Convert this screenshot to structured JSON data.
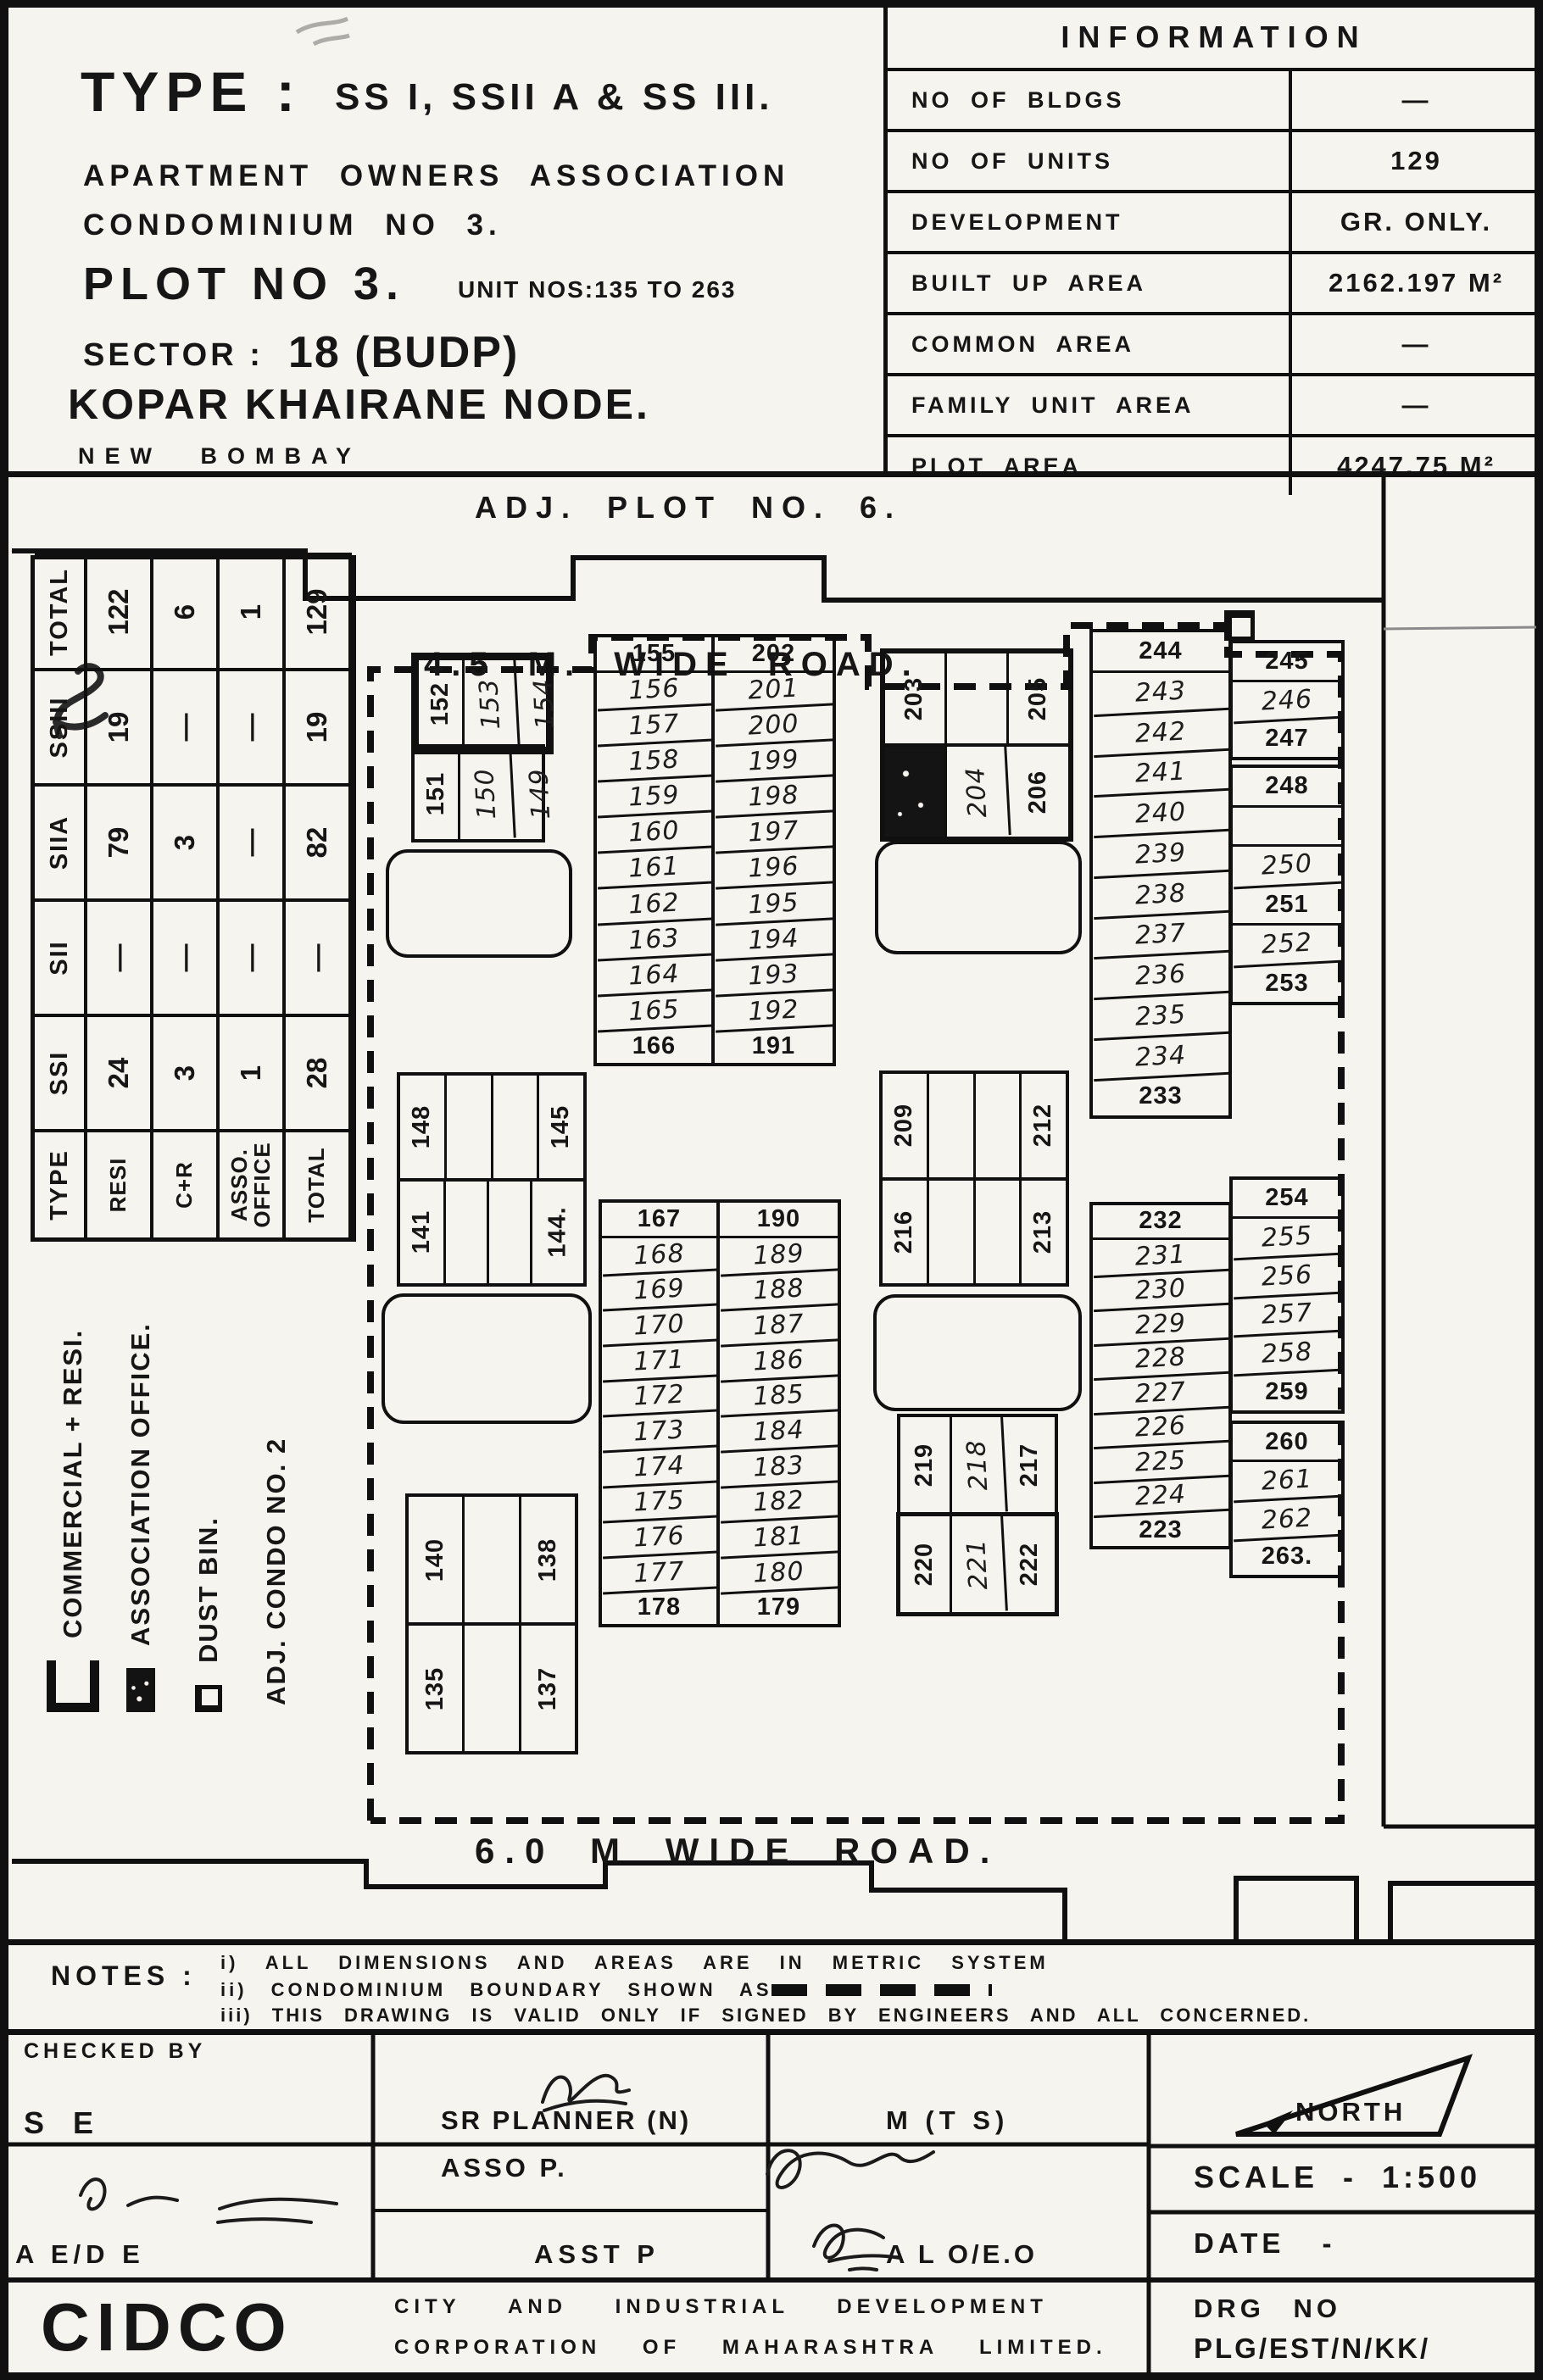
{
  "title_block": {
    "type_label": "TYPE :",
    "type_value": "SS I, SSII A & SS III.",
    "line_association": "APARTMENT OWNERS ASSOCIATION",
    "line_condominium": "CONDOMINIUM NO 3.",
    "plot_label": "PLOT NO 3.",
    "unit_nos": "UNIT NOS:135 TO 263",
    "sector_label": "SECTOR :",
    "sector_value": "18 (BUDP)",
    "node_line": "KOPAR KHAIRANE NODE.",
    "city_line": "NEW BOMBAY"
  },
  "info_table": {
    "title": "INFORMATION",
    "rows": [
      {
        "label": "NO OF BLDGS",
        "value": "—"
      },
      {
        "label": "NO OF UNITS",
        "value": "129"
      },
      {
        "label": "DEVELOPMENT",
        "value": "GR. ONLY."
      },
      {
        "label": "BUILT UP AREA",
        "value": "2162.197 M²"
      },
      {
        "label": "COMMON AREA",
        "value": "—"
      },
      {
        "label": "FAMILY UNIT AREA",
        "value": "—"
      },
      {
        "label": "PLOT AREA",
        "value": "4247.75 M²"
      }
    ]
  },
  "summary_table": {
    "col_headers": [
      "TYPE",
      "SSI",
      "SII",
      "SIIA",
      "SSIII",
      "TOTAL"
    ],
    "rows": [
      {
        "label": "RESI",
        "values": [
          "24",
          "—",
          "79",
          "19",
          "122"
        ]
      },
      {
        "label": "C+R",
        "values": [
          "3",
          "—",
          "3",
          "—",
          "6"
        ]
      },
      {
        "label": "ASSO. OFFICE",
        "values": [
          "1",
          "—",
          "—",
          "—",
          "1"
        ]
      },
      {
        "label": "TOTAL",
        "values": [
          "28",
          "—",
          "82",
          "19",
          "129"
        ]
      }
    ]
  },
  "legend": {
    "items": [
      {
        "symbol": "commercial",
        "label": "COMMERCIAL + RESI."
      },
      {
        "symbol": "association",
        "label": "ASSOCIATION OFFICE."
      },
      {
        "symbol": "dustbin",
        "label": "DUST BIN."
      },
      {
        "symbol": "none",
        "label": "ADJ. CONDO NO. 2"
      }
    ]
  },
  "plan": {
    "adj_plot_top": "ADJ. PLOT NO. 6.",
    "road_top": "4.5 M. WIDE ROAD.",
    "road_bottom": "6.0 M WIDE ROAD.",
    "adj_condo_right": "ADJ. CONDO NO. 4.",
    "block_a": {
      "vertical": true,
      "rows": [
        [
          "152",
          {
            "v": "153",
            "hw": true
          },
          {
            "v": "154",
            "hw": true
          }
        ]
      ]
    },
    "block_b": {
      "vertical": true,
      "rows": [
        [
          "151",
          {
            "v": "150",
            "hw": true
          },
          {
            "v": "149",
            "hw": true
          }
        ]
      ]
    },
    "block_c": {
      "vertical": true,
      "rows": [
        [
          "148",
          "",
          "",
          "145"
        ],
        [
          "141",
          "",
          "",
          "144."
        ]
      ]
    },
    "block_d": {
      "vertical": true,
      "rows": [
        [
          "140",
          "",
          "138"
        ],
        [
          "135",
          "",
          "137"
        ]
      ]
    },
    "block_e": {
      "vertical": true,
      "rows": [
        [
          "203",
          "",
          "205"
        ],
        [
          {
            "fill": true
          },
          {
            "v": "204",
            "hw": true
          },
          "206"
        ]
      ]
    },
    "block_f": {
      "vertical": true,
      "rows": [
        [
          "209",
          "",
          "",
          "212"
        ],
        [
          "216",
          "",
          "",
          "213"
        ]
      ]
    },
    "block_g": {
      "vertical": true,
      "bold_row": 1,
      "rows": [
        [
          "219",
          {
            "v": "218",
            "hw": true
          },
          "217"
        ],
        [
          "220",
          {
            "v": "221",
            "hw": true
          },
          "222"
        ]
      ]
    },
    "strip_155_left": [
      "155",
      {
        "v": "156",
        "hw": true
      },
      {
        "v": "157",
        "hw": true
      },
      {
        "v": "158",
        "hw": true
      },
      {
        "v": "159",
        "hw": true
      },
      {
        "v": "160",
        "hw": true
      },
      {
        "v": "161",
        "hw": true
      },
      {
        "v": "162",
        "hw": true
      },
      {
        "v": "163",
        "hw": true
      },
      {
        "v": "164",
        "hw": true
      },
      {
        "v": "165",
        "hw": true
      },
      "166"
    ],
    "strip_155_right": [
      "202",
      {
        "v": "201",
        "hw": true
      },
      {
        "v": "200",
        "hw": true
      },
      {
        "v": "199",
        "hw": true
      },
      {
        "v": "198",
        "hw": true
      },
      {
        "v": "197",
        "hw": true
      },
      {
        "v": "196",
        "hw": true
      },
      {
        "v": "195",
        "hw": true
      },
      {
        "v": "194",
        "hw": true
      },
      {
        "v": "193",
        "hw": true
      },
      {
        "v": "192",
        "hw": true
      },
      "191"
    ],
    "strip_167_left": [
      "167",
      {
        "v": "168",
        "hw": true
      },
      {
        "v": "169",
        "hw": true
      },
      {
        "v": "170",
        "hw": true
      },
      {
        "v": "171",
        "hw": true
      },
      {
        "v": "172",
        "hw": true
      },
      {
        "v": "173",
        "hw": true
      },
      {
        "v": "174",
        "hw": true
      },
      {
        "v": "175",
        "hw": true
      },
      {
        "v": "176",
        "hw": true
      },
      {
        "v": "177",
        "hw": true
      },
      "178"
    ],
    "strip_167_right": [
      "190",
      {
        "v": "189",
        "hw": true
      },
      {
        "v": "188",
        "hw": true
      },
      {
        "v": "187",
        "hw": true
      },
      {
        "v": "186",
        "hw": true
      },
      {
        "v": "185",
        "hw": true
      },
      {
        "v": "184",
        "hw": true
      },
      {
        "v": "183",
        "hw": true
      },
      {
        "v": "182",
        "hw": true
      },
      {
        "v": "181",
        "hw": true
      },
      {
        "v": "180",
        "hw": true
      },
      "179"
    ],
    "strip_244": [
      "244",
      {
        "v": "243",
        "hw": true
      },
      {
        "v": "242",
        "hw": true
      },
      {
        "v": "241",
        "hw": true
      },
      {
        "v": "240",
        "hw": true
      },
      {
        "v": "239",
        "hw": true
      },
      {
        "v": "238",
        "hw": true
      },
      {
        "v": "237",
        "hw": true
      },
      {
        "v": "236",
        "hw": true
      },
      {
        "v": "235",
        "hw": true
      },
      {
        "v": "234",
        "hw": true
      },
      "233"
    ],
    "strip_232": [
      "232",
      {
        "v": "231",
        "hw": true
      },
      {
        "v": "230",
        "hw": true
      },
      {
        "v": "229",
        "hw": true
      },
      {
        "v": "228",
        "hw": true
      },
      {
        "v": "227",
        "hw": true
      },
      {
        "v": "226",
        "hw": true
      },
      {
        "v": "225",
        "hw": true
      },
      {
        "v": "224",
        "hw": true
      },
      "223"
    ],
    "strip_245_g1": [
      "245",
      {
        "v": "246",
        "hw": true
      },
      "247"
    ],
    "strip_245_g2": [
      "248",
      "",
      {
        "v": "250",
        "hw": true
      },
      "251",
      {
        "v": "252",
        "hw": true
      },
      "253"
    ],
    "strip_245_g3": [
      "254",
      {
        "v": "255",
        "hw": true
      },
      {
        "v": "256",
        "hw": true
      },
      {
        "v": "257",
        "hw": true
      },
      {
        "v": "258",
        "hw": true
      },
      "259"
    ],
    "strip_245_g4": [
      "260",
      {
        "v": "261",
        "hw": true
      },
      {
        "v": "262",
        "hw": true
      },
      "263."
    ]
  },
  "notes": {
    "label": "NOTES :",
    "item1": "i) ALL DIMENSIONS AND AREAS ARE IN METRIC SYSTEM",
    "item2": "ii) CONDOMINIUM BOUNDARY SHOWN AS",
    "item3": "iii) THIS DRAWING IS VALID ONLY IF SIGNED BY ENGINEERS AND ALL CONCERNED."
  },
  "approval_strip": {
    "checked_by_label": "CHECKED BY",
    "checked_by": "S E",
    "planner": "SR PLANNER (N)",
    "mts": "M (T S)",
    "aede": "A E/D E",
    "asso": "ASSO P.",
    "asst": "ASST P",
    "aloeo": "A L O/E.O",
    "north": "NORTH",
    "scale": "SCALE - 1:500",
    "date": "DATE -",
    "drg_label": "DRG NO",
    "drg_no": "PLG/EST/N/KK/",
    "org": "CIDCO",
    "org_line1": "CITY AND INDUSTRIAL DEVELOPMENT",
    "org_line2": "CORPORATION OF MAHARASHTRA LIMITED."
  }
}
